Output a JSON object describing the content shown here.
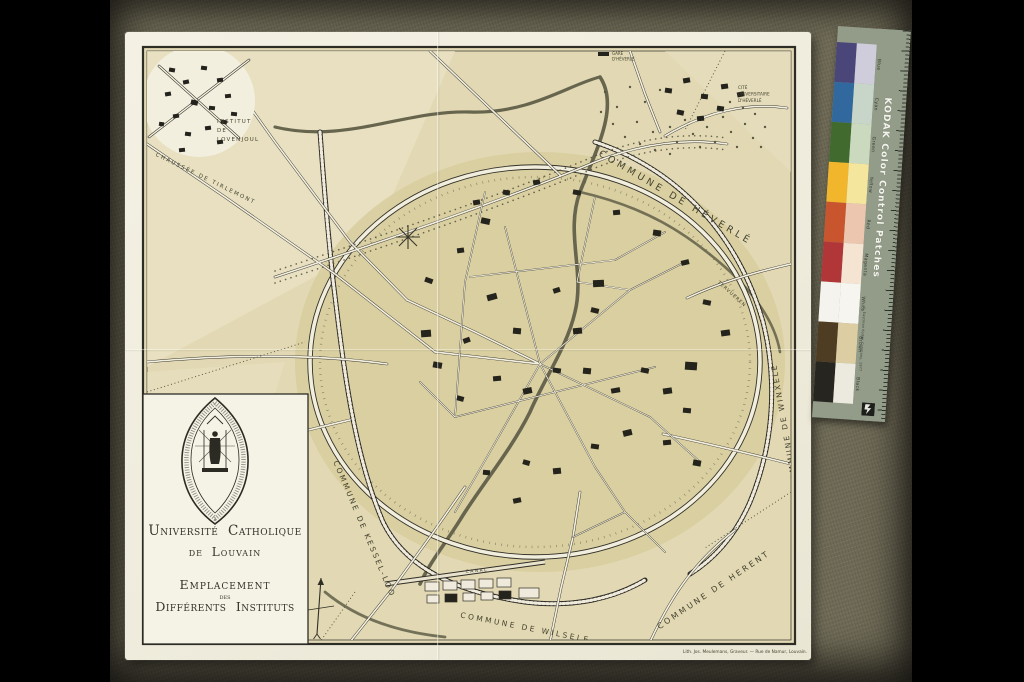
{
  "scene": {
    "bar_color": "#000000",
    "mat_color": "#6f6a56",
    "paper_color": "#f1ede0",
    "map_ground_color": "#e0d7b0",
    "ink_color": "#34322a"
  },
  "map": {
    "labels": {
      "institut": [
        "INSTITUT",
        "DE",
        "LOVENJOUL"
      ],
      "chaussee": "CHAUSSÉE DE TIRLEMONT",
      "gare": [
        "GARE",
        "D'HÉVERLÉ"
      ],
      "cite": [
        "CITÉ",
        "UNIVERSITAIRE",
        "D'HÉVERLÉ"
      ],
      "commune_heverle": "COMMUNE DE HÉVERLÉ",
      "commune_winxele": "COMMUNE DE WINXELE",
      "commune_herent": "COMMUNE DE HERENT",
      "commune_wilsele": "COMMUNE DE WILSELE",
      "commune_kessel_loo": "COMMUNE DE KESSEL-LOO",
      "canal": "CANAL",
      "tervueren": "TERVUEREN"
    },
    "cartouche": {
      "line1": "Université Catholique",
      "line2": "de Louvain",
      "line3": "Emplacement",
      "line4": "des",
      "line5": "Différents Instituts",
      "seal_icon": "sedes-sapientiae-seal"
    },
    "imprint": "Lith. Jos. Meulemans, Graveur. — Rue de Namur, Louvain."
  },
  "kodak_strip": {
    "title": "KODAK Color Control Patches",
    "credit": "© Eastman Kodak Company, 1977",
    "ruler_color": "#939b89",
    "patches": [
      {
        "label": "Blue",
        "solid": "#4a4679",
        "tint": "#cfccdb"
      },
      {
        "label": "Cyan",
        "solid": "#31699e",
        "tint": "#c7d6c9"
      },
      {
        "label": "Green",
        "solid": "#406a2e",
        "tint": "#cbd9bf"
      },
      {
        "label": "Yellow",
        "solid": "#f2b62c",
        "tint": "#f4e79d"
      },
      {
        "label": "Red",
        "solid": "#c8552e",
        "tint": "#ecc6ae"
      },
      {
        "label": "Magenta",
        "solid": "#b13637",
        "tint": "#f6e4d3"
      },
      {
        "label": "White",
        "solid": "#f4f3ed",
        "tint": "#f6f5ef"
      },
      {
        "label": "Brown",
        "solid": "#4e3d22",
        "tint": "#dccda2"
      },
      {
        "label": "Black",
        "solid": "#272520",
        "tint": "#eceade"
      }
    ]
  }
}
